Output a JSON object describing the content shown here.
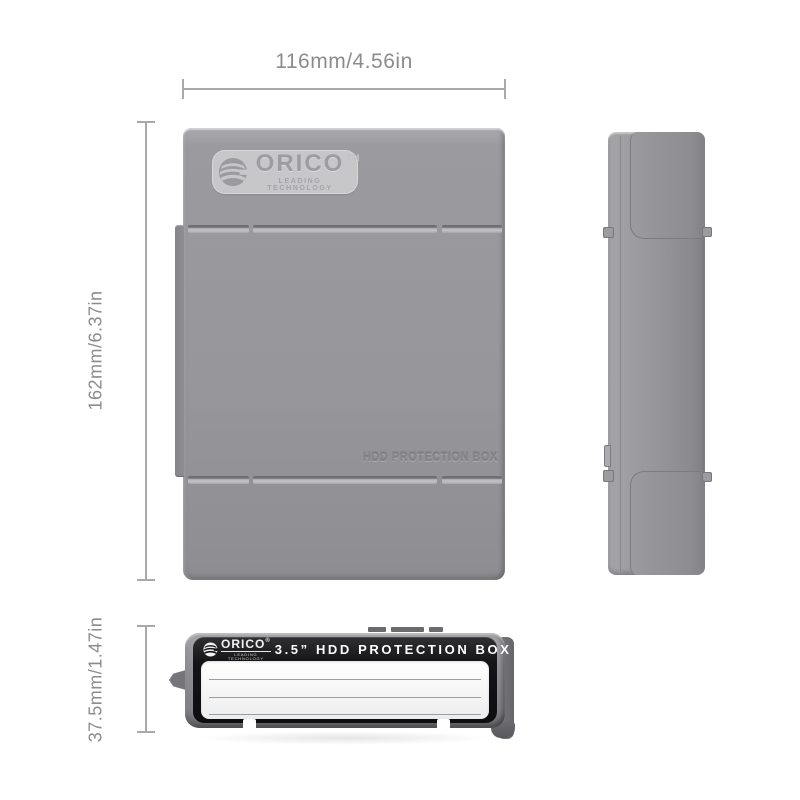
{
  "annotations": {
    "width": "116mm/4.56in",
    "height": "162mm/6.37in",
    "thickness": "37.5mm/1.47in"
  },
  "brand": {
    "name": "ORICO",
    "trademark": "TM",
    "registered": "®",
    "tagline": "LEADING TECHNOLOGY"
  },
  "front": {
    "embossed_text": "HDD PROTECTION BOX"
  },
  "bottom_label": {
    "title": "3.5” HDD PROTECTION BOX"
  },
  "colors": {
    "body_gray": "#96969a",
    "plate_gray": "#c7c7ca",
    "label_black": "#141416",
    "label_white": "#f4f4f5",
    "dimension_gray": "#8c8c8c",
    "background": "#ffffff"
  }
}
